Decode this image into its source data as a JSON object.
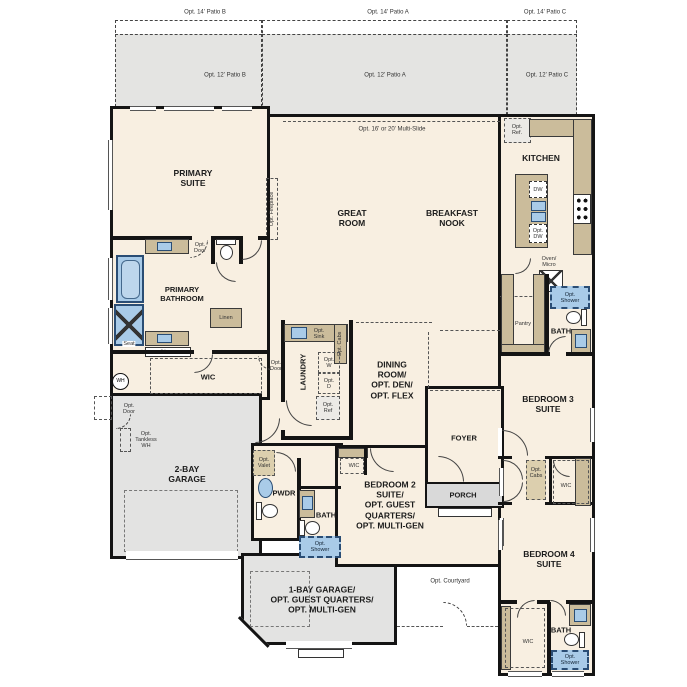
{
  "colors": {
    "wall": "#141414",
    "interior": "#f8efe1",
    "patio": "#e4e4e2",
    "garage": "#e3e3e2",
    "porch": "#d9d9d9",
    "cabinet": "#cbbc9b",
    "fixture_blue": "#a9cbe8"
  },
  "labels": {
    "patio14b": "Opt. 14' Patio B",
    "patio14a": "Opt. 14' Patio A",
    "patio14c": "Opt. 14' Patio C",
    "patio12b": "Opt. 12' Patio B",
    "patio12a": "Opt. 12' Patio A",
    "patio12c": "Opt. 12' Patio C",
    "multi_slide": "Opt. 16' or 20' Multi-Slide",
    "primary_suite": "PRIMARY\nSUITE",
    "opt_fireplace": "Opt. Fireplace",
    "great_room": "GREAT\nROOM",
    "breakfast_nook": "BREAKFAST\nNOOK",
    "kitchen": "KITCHEN",
    "opt_ref_kitchen": "Opt.\nRef.",
    "dw": "DW",
    "opt_dw": "Opt.\nDW",
    "oven_micro": "Oven/\nMicro",
    "primary_bathroom": "PRIMARY\nBATHROOM",
    "opt_door_bath": "Opt.\nDoor",
    "seat": "Seat",
    "linen_right": "Linen",
    "linen_bottom": "Linen",
    "wic_primary": "WIC",
    "opt_door_wic": "Opt.\nDoor",
    "wh": "WH",
    "opt_door_garage": "Opt.\nDoor",
    "opt_tankless": "Opt.\nTankless\nWH",
    "garage2": "2-BAY\nGARAGE",
    "laundry": "LAUNDRY",
    "opt_sink": "Opt.\nSink",
    "opt_cabs_laundry": "Opt. Cabs",
    "opt_w": "Opt.\nW",
    "opt_d": "Opt.\nD",
    "opt_ref_laundry": "Opt.\nRef",
    "dining": "DINING\nROOM/\nOPT. DEN/\nOPT. FLEX",
    "foyer": "FOYER",
    "porch": "PORCH",
    "opt_valet": "Opt.\nValet",
    "pwdr": "PWDR",
    "wic_bed2": "WIC",
    "bath_bed2": "BATH",
    "opt_shower_bed2": "Opt.\nShower",
    "bedroom2": "BEDROOM 2\nSUITE/\nOPT. GUEST\nQUARTERS/\nOPT. MULTI-GEN",
    "pantry": "Pantry",
    "bath3": "BATH",
    "opt_shower_bath3": "Opt.\nShower",
    "bedroom3": "BEDROOM 3\nSUITE",
    "opt_cabs_hall": "Opt.\nCabs",
    "wic_bed3": "WIC",
    "bedroom4": "BEDROOM 4\nSUITE",
    "wic_bed4": "WIC",
    "bath4": "BATH",
    "opt_shower_bath4": "Opt.\nShower",
    "garage1": "1-BAY GARAGE/\nOPT. GUEST QUARTERS/\nOPT. MULTI-GEN",
    "opt_courtyard": "Opt. Courtyard"
  }
}
